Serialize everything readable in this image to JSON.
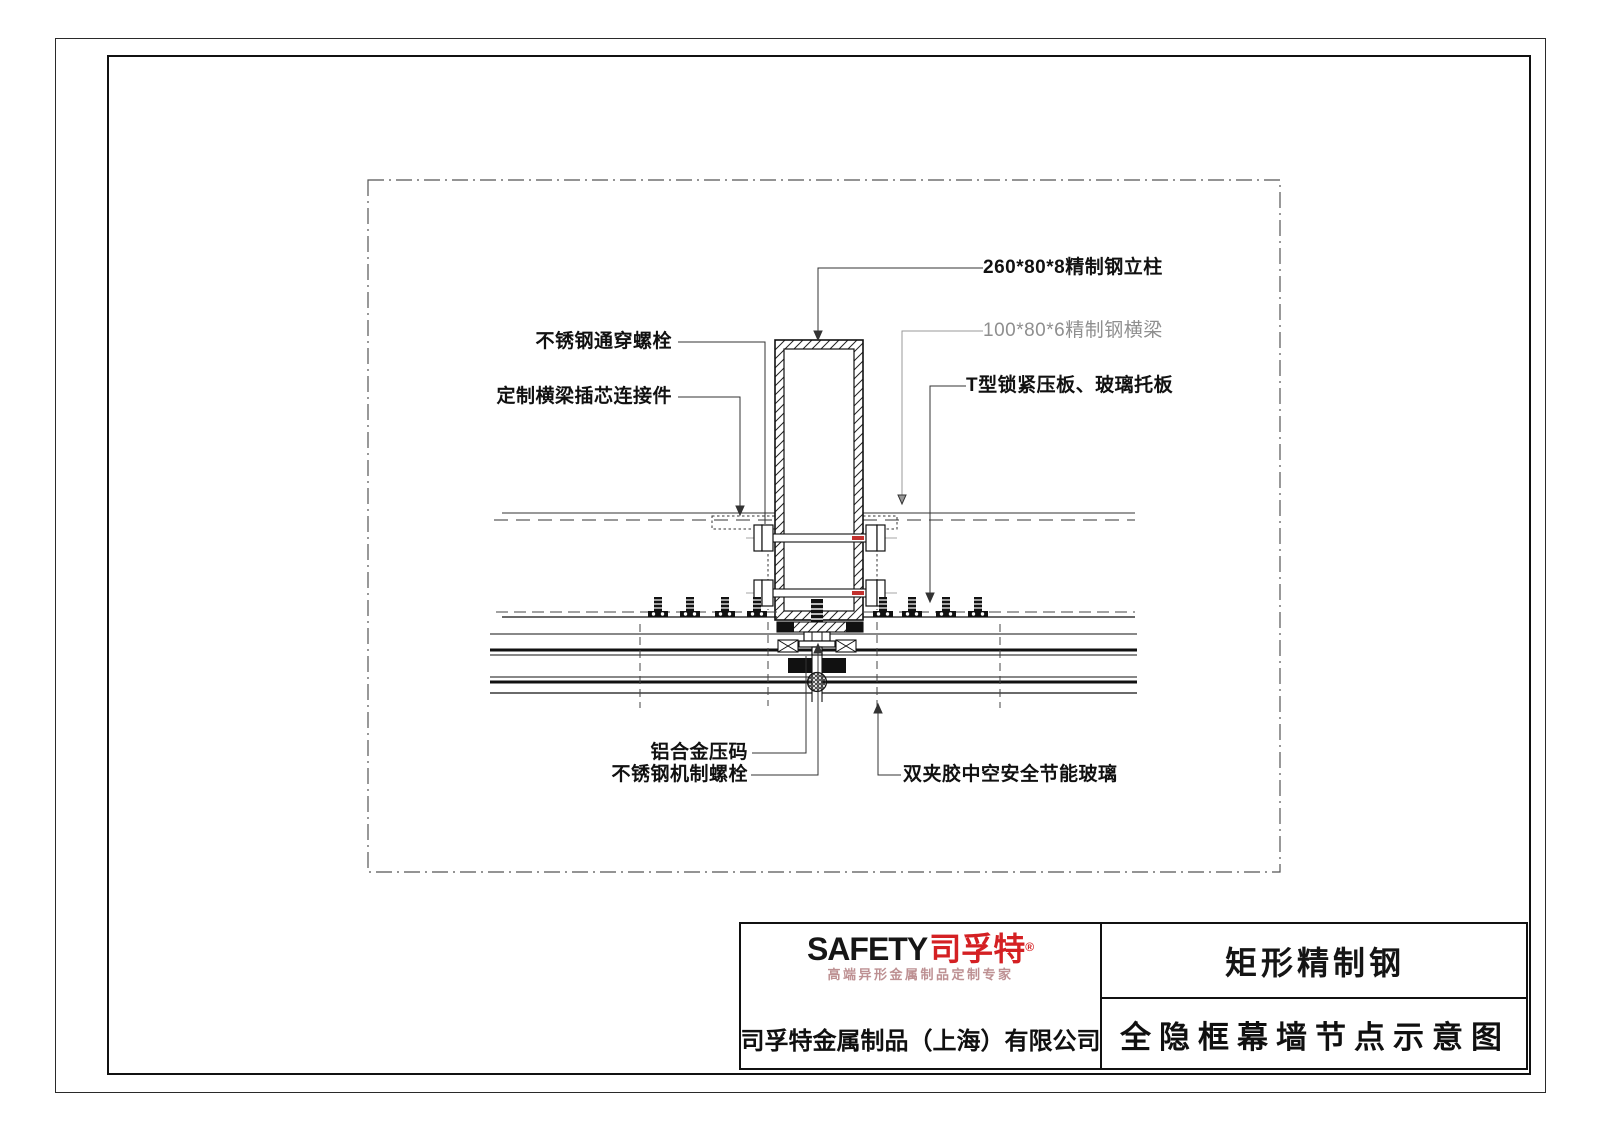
{
  "drawing": {
    "labels": {
      "column": "260*80*8精制钢立柱",
      "beam": "100*80*6精制钢横梁",
      "t_plate": "T型锁紧压板、玻璃托板",
      "through_bolt": "不锈钢通穿螺栓",
      "connector": "定制横梁插芯连接件",
      "al_block": "铝合金压码",
      "machine_bolt": "不锈钢机制螺栓",
      "glass": "双夹胶中空安全节能玻璃"
    }
  },
  "title_block": {
    "logo": {
      "safety": "SAFETY",
      "brand": "司孚特",
      "reg": "®",
      "tagline": "高端异形金属制品定制专家"
    },
    "company": "司孚特金属制品（上海）有限公司",
    "product": "矩形精制钢",
    "drawing_title": "全隐框幕墙节点示意图"
  },
  "colors": {
    "brand_red": "#d42023",
    "label_gray": "#8f8f8f",
    "bolt_accent_red": "#c2312e"
  }
}
